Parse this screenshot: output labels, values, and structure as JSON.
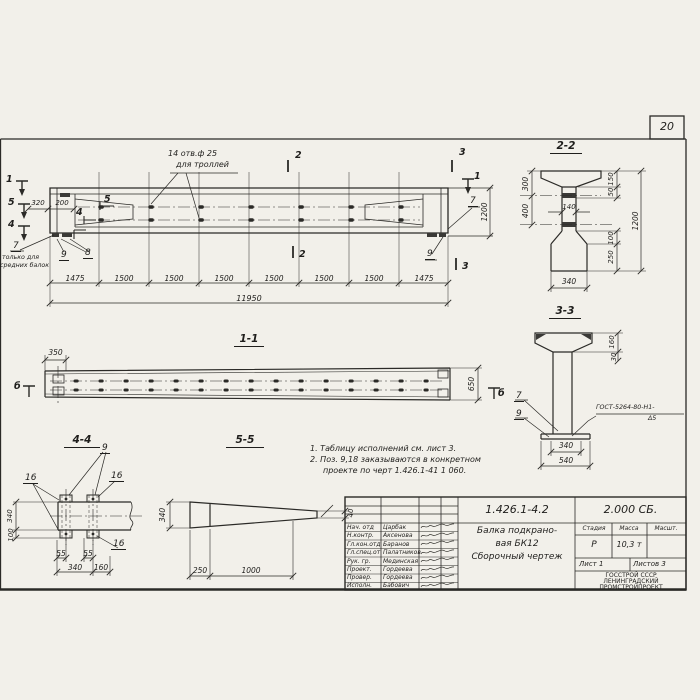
{
  "colors": {
    "paper": "#f2f0ea",
    "ink": "#2b2a27"
  },
  "page": {
    "number": "20"
  },
  "main_view": {
    "hole_note1": "14 отв.ф 25",
    "hole_note2": "для троллей",
    "dim_320": "320",
    "dim_200": "200",
    "m1": "1",
    "m5": "5",
    "m4": "4",
    "m1r": "1",
    "m2": "2",
    "m3": "3",
    "cut5": "5",
    "cut4": "4",
    "c7": "7",
    "c7_note1": "только для",
    "c7_note2": "средних балок",
    "c8": "8",
    "c9": "9",
    "c7r": "7",
    "c9r": "9",
    "dims": [
      "1475",
      "1500",
      "1500",
      "1500",
      "1500",
      "1500",
      "1500",
      "1475"
    ],
    "total": "11950",
    "height": "1200"
  },
  "sections": {
    "s22": {
      "label": "2-2",
      "d300": "300",
      "d400": "400",
      "d140": "140",
      "d150": "150",
      "d50": "50",
      "d1200": "1200",
      "d100": "100",
      "d250": "250",
      "d340": "340"
    },
    "s33": {
      "label": "3-3",
      "d160": "160",
      "d30": "30",
      "d340": "340",
      "d540": "540",
      "c7": "7",
      "c9": "9",
      "weld1": "ГОСТ-5264-80-Н1-",
      "weld2": "Δ5"
    },
    "s11": {
      "label": "1-1",
      "d350": "350",
      "d650": "650",
      "mb": "б"
    },
    "s44": {
      "label": "4-4",
      "c9": "9",
      "c16": "16",
      "d340v": "340",
      "d100": "100",
      "d55": "55",
      "d340": "340",
      "d160": "160"
    },
    "s55": {
      "label": "5-5",
      "d340": "340",
      "d250": "250",
      "d1000": "1000",
      "d40": "40"
    }
  },
  "notes": {
    "n1": "1. Таблицу исполнений см. лист 3.",
    "n2": "2. Поз. 9,18 заказываются в конкретном",
    "n3": "проекте по черт 1.426.1-41 1 060."
  },
  "title_block": {
    "doc_number": "1.426.1-4.2",
    "doc_code": "2.000 СБ.",
    "title_line1": "Балка подкрано-",
    "title_line2": "вая БК12",
    "title_line3": "Сборочный чертеж",
    "col_stage": "Стадия",
    "col_mass": "Масса",
    "col_scale": "Масшт.",
    "stage": "Р",
    "mass": "10,3 т",
    "sheet": "Лист 1",
    "sheets": "Листов 3",
    "org_line1": "ГОССТРОЙ СССР",
    "org_line2": "ЛЕНИНГРАДСКИЙ",
    "org_line3": "ПРОМСТРОЙПРОЕКТ",
    "rows": [
      {
        "role": "Нач. отд",
        "name": "Царбак"
      },
      {
        "role": "Н.контр.",
        "name": "Аксенова"
      },
      {
        "role": "Гл.кон.отд",
        "name": "Баранов"
      },
      {
        "role": "Гл.спец.от",
        "name": "Палатников"
      },
      {
        "role": "Рук. гр.",
        "name": "Мединская"
      },
      {
        "role": "Проект.",
        "name": "Гордеева"
      },
      {
        "role": "Провер.",
        "name": "Гордеева"
      },
      {
        "role": "Исполн.",
        "name": "Бабович"
      }
    ]
  }
}
